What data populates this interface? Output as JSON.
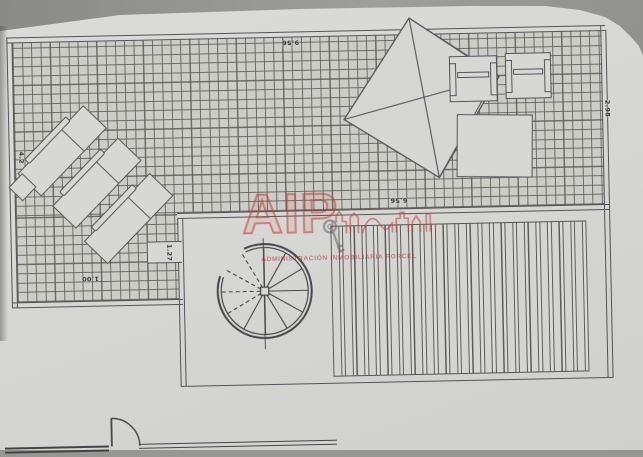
{
  "document": {
    "kind": "roof terrace floor plan (photographed drawing)"
  },
  "dimensions": {
    "top_width": "9.56",
    "right_height": "2.98",
    "inner_width": "6.56",
    "left_height": "4.2",
    "stair_side": "1.27",
    "ledge": "1.00"
  },
  "watermark": {
    "initials": "AIP",
    "company": "ADMINISTRACIÓN INMOBILIARIA PORCEL",
    "color": "#b23430"
  },
  "palette": {
    "paper": "#d7d7d4",
    "ink": "#54545a",
    "background": "#969694",
    "watermark_red": "#c13a32"
  },
  "symbols": [
    "tiled-terrace-grid",
    "sun-lounger",
    "side-table",
    "parasol",
    "chair",
    "table",
    "spiral-staircase",
    "deck-boards",
    "door-swing",
    "wall"
  ]
}
